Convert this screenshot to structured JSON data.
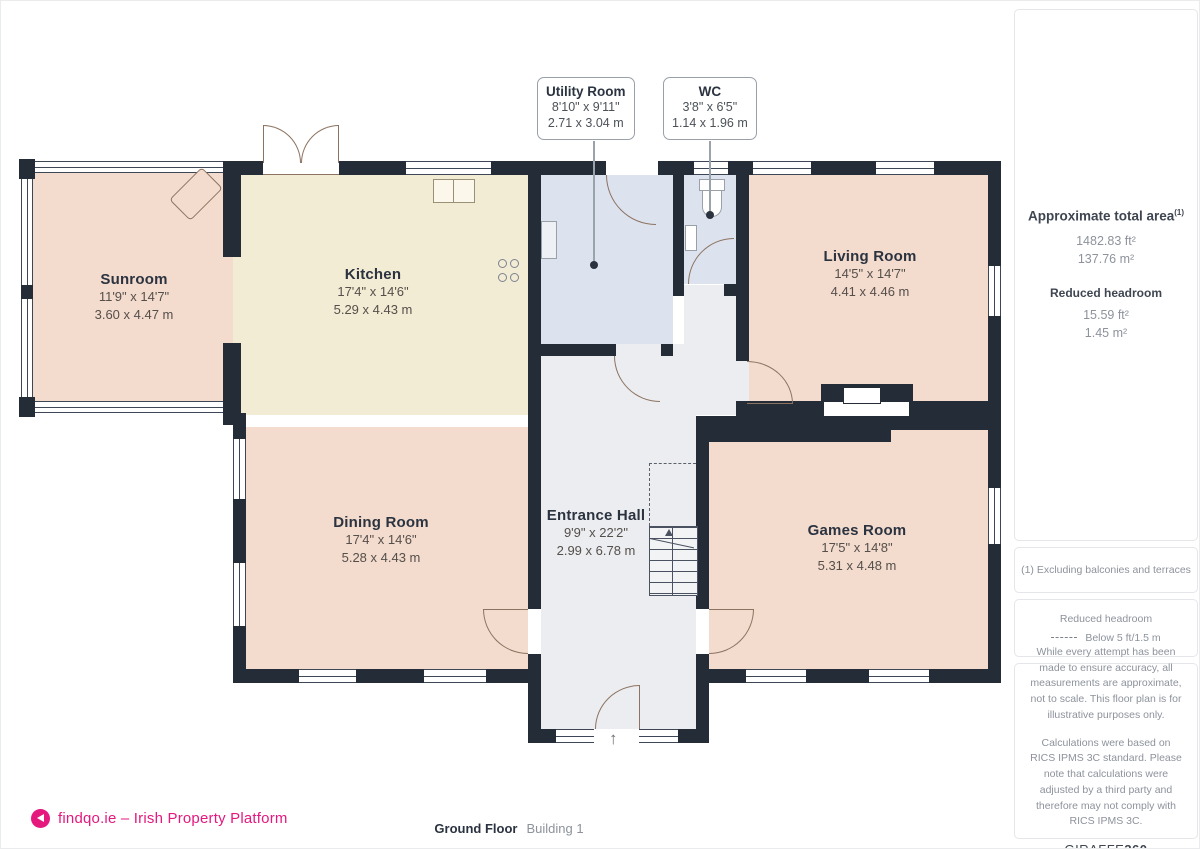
{
  "plan": {
    "rooms": [
      {
        "id": "sunroom",
        "name": "Sunroom",
        "imperial": "11'9\" x 14'7\"",
        "metric": "3.60 x 4.47 m"
      },
      {
        "id": "kitchen",
        "name": "Kitchen",
        "imperial": "17'4\" x 14'6\"",
        "metric": "5.29 x 4.43 m"
      },
      {
        "id": "living",
        "name": "Living Room",
        "imperial": "14'5\" x 14'7\"",
        "metric": "4.41 x 4.46 m"
      },
      {
        "id": "dining",
        "name": "Dining Room",
        "imperial": "17'4\" x 14'6\"",
        "metric": "5.28 x 4.43 m"
      },
      {
        "id": "hall",
        "name": "Entrance Hall",
        "imperial": "9'9\" x 22'2\"",
        "metric": "2.99 x 6.78 m"
      },
      {
        "id": "games",
        "name": "Games Room",
        "imperial": "17'5\" x 14'8\"",
        "metric": "5.31 x 4.48 m"
      }
    ],
    "callouts": [
      {
        "name": "Utility Room",
        "imperial": "8'10\" x 9'11\"",
        "metric": "2.71 x 3.04 m"
      },
      {
        "name": "WC",
        "imperial": "3'8\" x 6'5\"",
        "metric": "1.14 x 1.96 m"
      }
    ]
  },
  "sidebar": {
    "total_area_label": "Approximate total area",
    "total_area_sup": "(1)",
    "total_area_ft": "1482.83 ft²",
    "total_area_m": "137.76 m²",
    "reduced_headroom_label": "Reduced headroom",
    "reduced_headroom_ft": "15.59 ft²",
    "reduced_headroom_m": "1.45 m²",
    "footnote": "(1) Excluding balconies and terraces",
    "legend_title": "Reduced headroom",
    "legend_value": "Below 5 ft/1.5 m",
    "disclaimer_1": "While every attempt has been made to ensure accuracy, all measurements are approximate, not to scale. This floor plan is for illustrative purposes only.",
    "disclaimer_2": "Calculations were based on RICS IPMS 3C standard. Please note that calculations were adjusted by a third party and therefore may not comply with RICS IPMS 3C.",
    "brand": "GIRAFFE",
    "brand_suffix": "360"
  },
  "footer": {
    "logo_text": "findqo.ie – Irish Property Platform",
    "floor_label": "Ground Floor",
    "building_label": "Building 1"
  },
  "colors": {
    "wall": "#242c38",
    "room_salmon": "#f3dbcd",
    "room_cream": "#f3ecd4",
    "room_blue": "#dde2ef",
    "room_grey": "#ebedf0",
    "accent_pink": "#e5187e"
  }
}
